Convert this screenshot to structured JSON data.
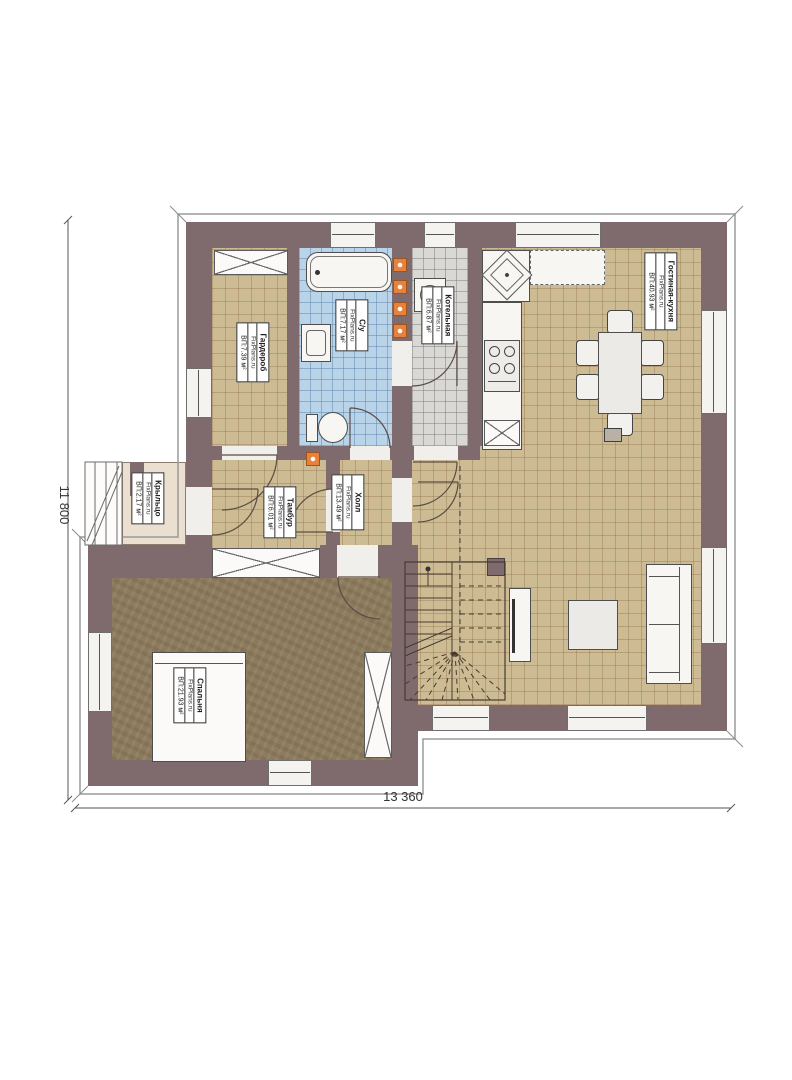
{
  "brand": "FixPlans.ru",
  "dimensions": {
    "width": "13 360",
    "height": "11 800"
  },
  "rooms": [
    {
      "name": "Гардероб",
      "brand": "FixPlans.ru",
      "area": "ВП:7.39 м²"
    },
    {
      "name": "С/у",
      "brand": "FixPlans.ru",
      "area": "ВП:7.17 м²"
    },
    {
      "name": "Котельная",
      "brand": "FixPlans.ru",
      "area": "ВП:6.87 м²"
    },
    {
      "name": "Гостиная-кухня",
      "brand": "FixPlans.ru",
      "area": "ВП:40.93 м²"
    },
    {
      "name": "Тамбур",
      "brand": "FixPlans.ru",
      "area": "ВП:6.01 м²"
    },
    {
      "name": "Холл",
      "brand": "FixPlans.ru",
      "area": "ВП:13.49 м²"
    },
    {
      "name": "Крыльцо",
      "brand": "FixPlans.ru",
      "area": "ВП:2.17 м²"
    },
    {
      "name": "Спальня",
      "brand": "FixPlans.ru",
      "area": "ВП:21.93 м²"
    }
  ],
  "colors": {
    "wall": "#7f6b6e",
    "floor_living": "#cdbc93",
    "floor_bedroom": "#8d7b5e",
    "floor_bath": "#b9d3e9",
    "floor_boiler": "#d9d8d5",
    "floor_porch": "#ebe0cf",
    "flue_orange": "#e8813a"
  }
}
